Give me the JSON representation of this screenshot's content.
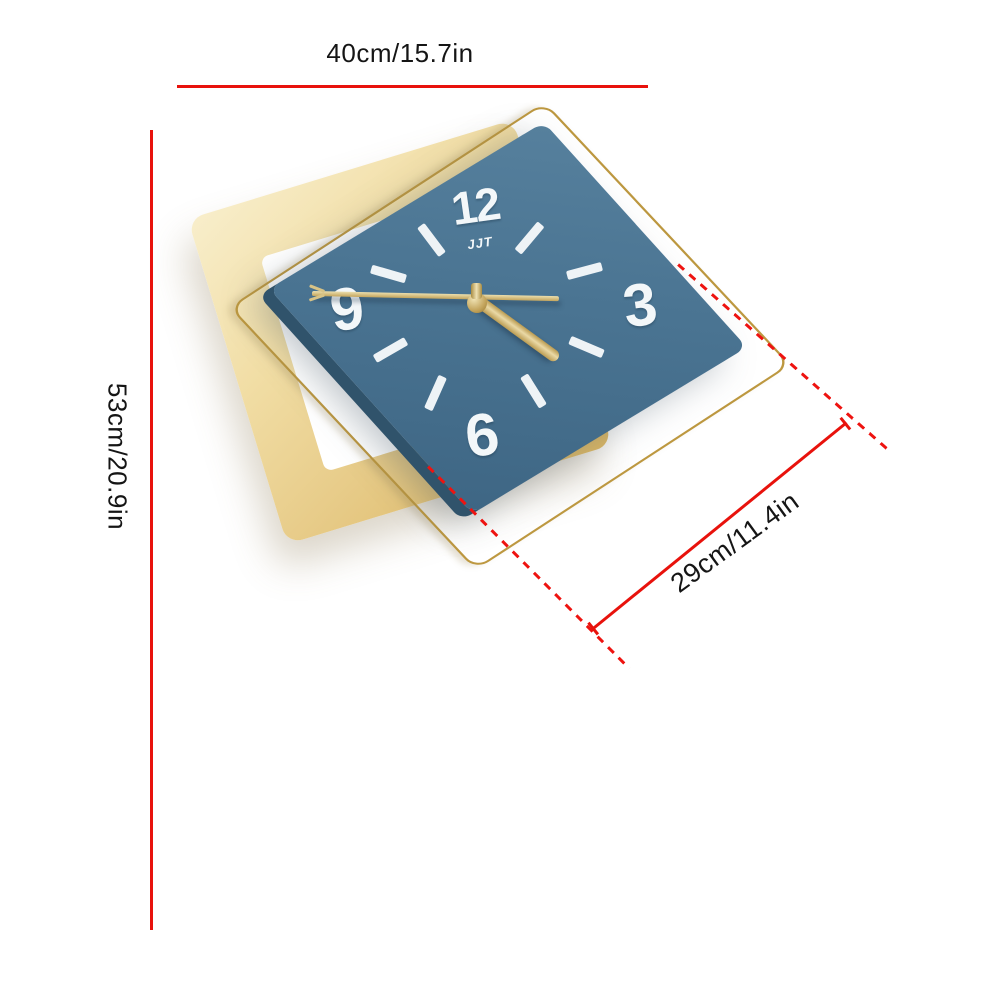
{
  "product": {
    "type": "square pendulum wall clock",
    "brand_logo": "JJT"
  },
  "dimensions": {
    "width_label": "40cm/15.7in",
    "height_label": "53cm/20.9in",
    "clock_face_label": "29cm/11.4in"
  },
  "clock": {
    "numerals": {
      "twelve": "12",
      "three": "3",
      "six": "6",
      "nine": "9"
    },
    "brand": "JJT",
    "tick_positions": "1,2,4,5,7,8,10,11"
  },
  "colors": {
    "annotation_red": "#e8120c",
    "label_text": "#151515",
    "gold_plate": "#e7cb88",
    "gold_wire": "#bd9840",
    "face_blue": "#4a7492",
    "face_side_blue": "#30536b",
    "numeral_white": "#f3f7f9",
    "hand_gold": "#d9c288",
    "background": "#ffffff"
  }
}
